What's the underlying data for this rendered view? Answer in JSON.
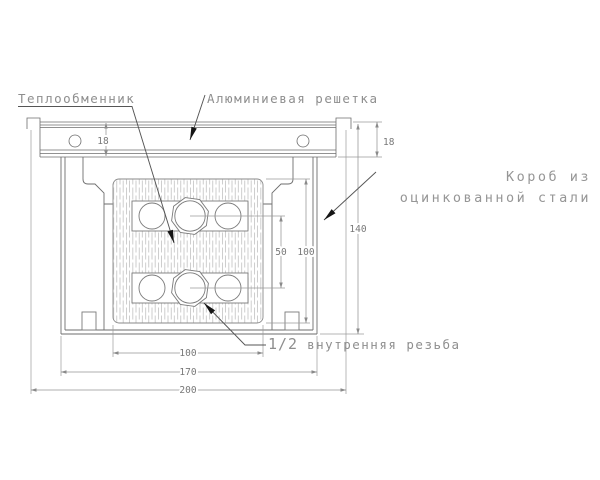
{
  "drawing": {
    "type": "technical-section-drawing",
    "labels": {
      "heat_exchanger": "Теплообменник",
      "aluminum_grille": "Алюминиевая решетка",
      "box_material_line1": "Короб из",
      "box_material_line2": "оцинкованной стали",
      "thread_size": "1/2",
      "thread_rest": " внутренняя резьба"
    },
    "dimensions": {
      "grille_height_left": "18",
      "grille_height_right": "18",
      "overall_height": "140",
      "core_height": "100",
      "pipe_spacing": "50",
      "core_width": "100",
      "box_width": "170",
      "overall_width": "200"
    },
    "colors": {
      "background": "#ffffff",
      "outline": "#6e6e6e",
      "dimension_line": "#949494",
      "hatch": "#bdbdbd",
      "label_text": "#8e8e8e",
      "leader_arrow": "#151515"
    }
  }
}
